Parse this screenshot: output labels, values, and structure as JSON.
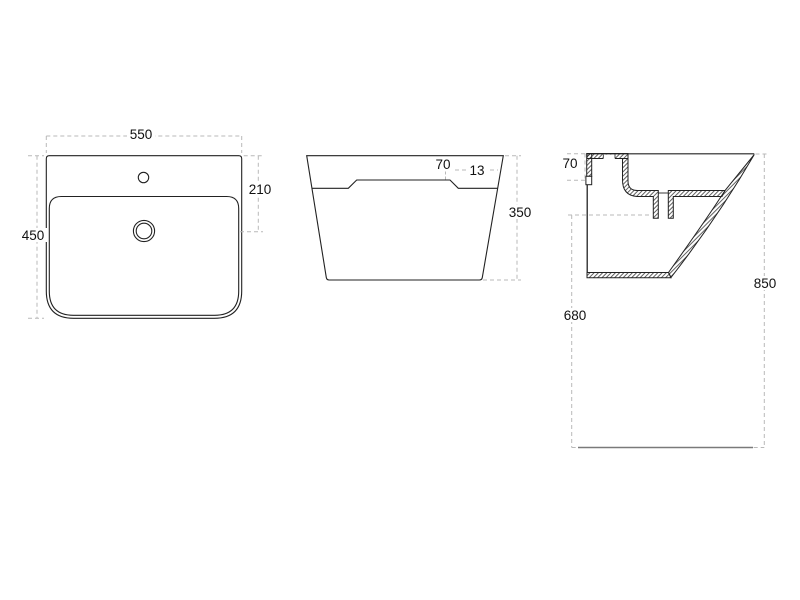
{
  "figure": {
    "kind": "technical-drawing",
    "views": [
      "top-view",
      "front-view",
      "side-section-view"
    ]
  },
  "dimensions": {
    "top_view": {
      "width": "550",
      "depth": "450",
      "drain_from_back": "210"
    },
    "front_view": {
      "deck_height": "70",
      "step": "13",
      "height": "350"
    },
    "side_view": {
      "deck_height": "70",
      "drain_to_floor": "680",
      "rim_to_floor": "850"
    }
  },
  "colors": {
    "background": "#ffffff",
    "line": "#222222",
    "dimension_line": "#b9b9b9",
    "floor_line": "#7a7a7a",
    "text": "#111111"
  }
}
